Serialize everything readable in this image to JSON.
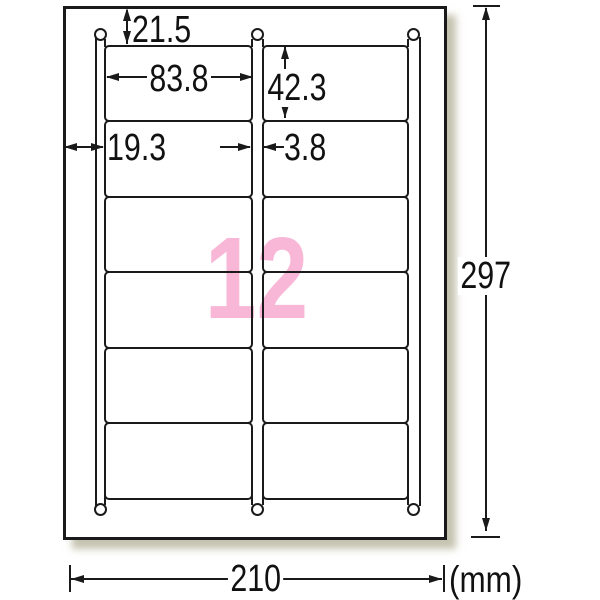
{
  "diagram": {
    "type": "label-sheet-dimension-diagram",
    "label_count": "12",
    "unit": "(mm)",
    "grid": {
      "rows": 6,
      "columns": 2
    },
    "dims": {
      "top_margin": "21.5",
      "label_width": "83.8",
      "label_height": "42.3",
      "side_margin": "19.3",
      "gap": "3.8",
      "page_height": "297",
      "page_width": "210"
    },
    "colors": {
      "line": "#1a1a1a",
      "pink": "#f8b7d7",
      "shadow": "#b8b294"
    }
  }
}
